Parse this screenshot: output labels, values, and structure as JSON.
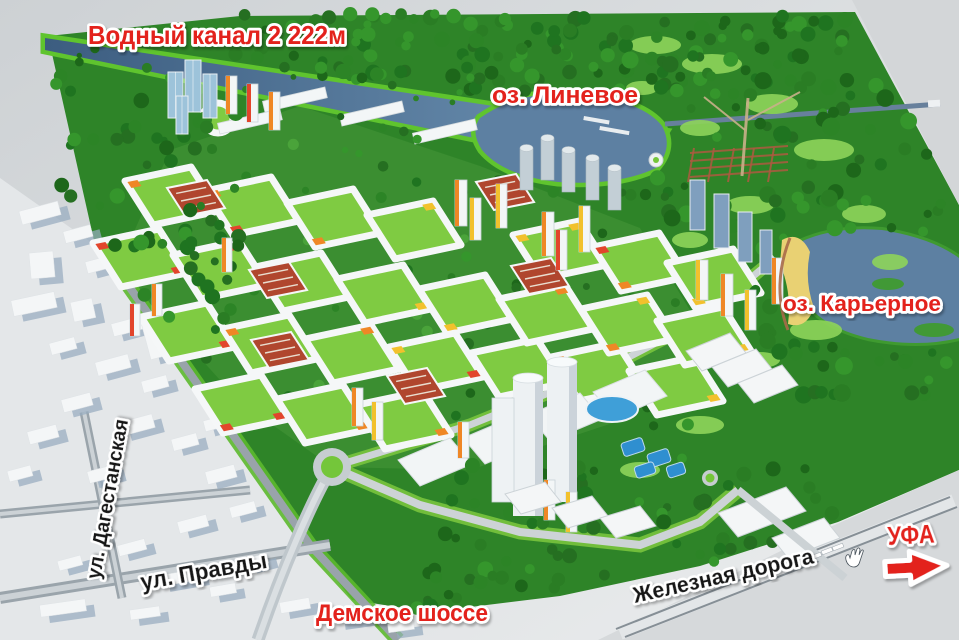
{
  "map": {
    "labels": {
      "water_canal": "Водный канал 2 222м",
      "lake_linevoe": "оз. Линевое",
      "lake_karyernoe": "оз. Карьерное",
      "street_dagestanskaya": "ул. Дагестанская",
      "street_pravdy": "ул. Правды",
      "demskoe_highway": "Демское шоссе",
      "railway": "Железная дорога",
      "city_ufa": "УФА"
    },
    "colors": {
      "label_red": "#e3201c",
      "label_black": "#161616",
      "label_outline": "#ffffff",
      "water": "#5d80a2",
      "forest": "#2e8428",
      "lawn": "#74c63a",
      "sand": "#e9d173",
      "city_grey": "#e4e7e9",
      "background_grey": "#d4d7d9"
    },
    "icons": {
      "ufa_arrow": "right-arrow-icon",
      "drag_cursor": "hand-cursor-icon"
    }
  }
}
